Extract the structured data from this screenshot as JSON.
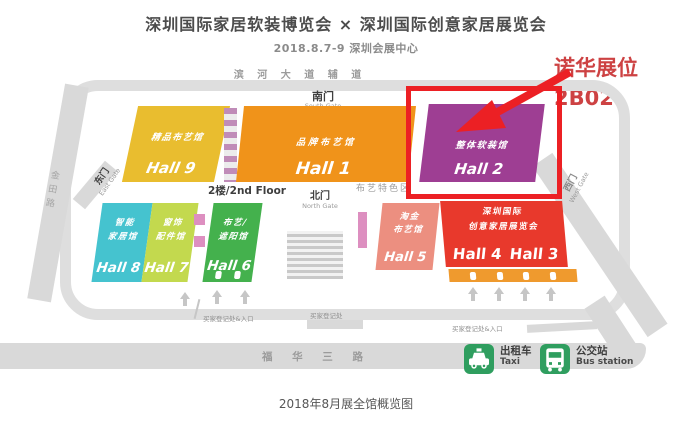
{
  "header": {
    "title": "深圳国际家居软装博览会 × 深圳国际创意家居展览会",
    "subtitle": "2018.8.7-9 深圳会展中心"
  },
  "annotation": {
    "line1": "诺华展位",
    "line2": "2B02"
  },
  "roads": {
    "top": "滨 河 大 道 辅 道",
    "bottom": "福 华 三 路",
    "left": "金田路"
  },
  "gates": {
    "south_zh": "南门",
    "south_en": "South Gate",
    "north_zh": "北门",
    "north_en": "North Gate",
    "east_zh": "东门",
    "east_en": "East Gate",
    "west_zh": "西门",
    "west_en": "West Gate"
  },
  "labels": {
    "floor": "2楼/2nd Floor",
    "fabric_area": "布艺特色区",
    "reg_left": "买家登记处&入口",
    "reg_center": "买家登记处",
    "reg_right": "买家登记处&入口"
  },
  "halls": [
    {
      "name": "精品布艺馆",
      "label": "Hall 9",
      "color": "#e9bd2f"
    },
    {
      "name": "品牌布艺馆",
      "label": "Hall 1",
      "color": "#f0931a"
    },
    {
      "name": "整体软装馆",
      "label": "Hall 2",
      "color": "#9e3e93"
    },
    {
      "line1": "智能",
      "line2": "家居馆",
      "label": "Hall 8",
      "color": "#45c3cf"
    },
    {
      "line1": "窗饰",
      "line2": "配件馆",
      "label": "Hall 7",
      "color": "#c3d94e"
    },
    {
      "line1": "布艺/",
      "line2": "遮阳馆",
      "label": "Hall 6",
      "color": "#44b14d"
    },
    {
      "line1": "淘金",
      "line2": "布艺馆",
      "label": "Hall 5",
      "color": "#ec8f80"
    },
    {
      "line1": "深圳国际",
      "line2": "创意家居展览会",
      "label": "Hall 4",
      "label2": "Hall 3",
      "color": "#e8392c"
    }
  ],
  "transport": {
    "taxi_zh": "出租车",
    "taxi_en": "Taxi",
    "bus_zh": "公交站",
    "bus_en": "Bus station"
  },
  "colors": {
    "highlight_red": "#ec2024",
    "entry_strip": "#ef9a2e",
    "transport_green": "#2f9e5f",
    "road_gray": "#d9d9d9"
  },
  "caption": "2018年8月展全馆概览图"
}
